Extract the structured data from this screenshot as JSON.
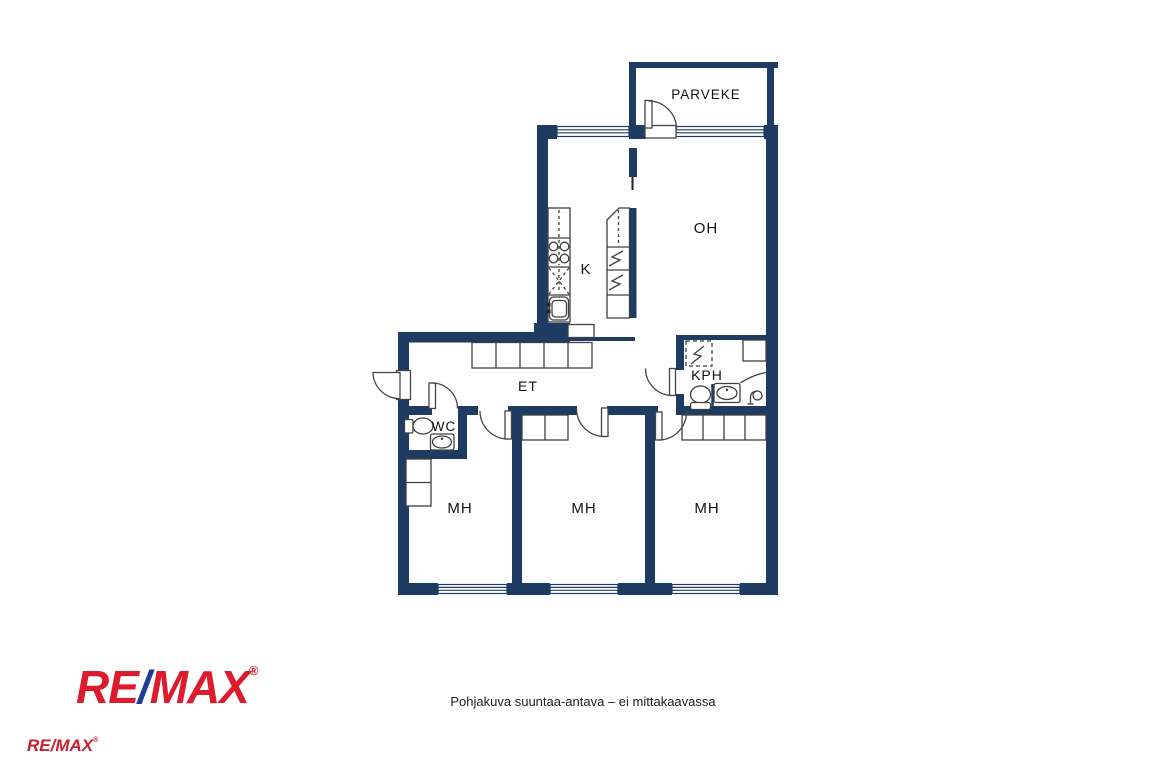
{
  "rooms": {
    "balcony": "PARVEKE",
    "living": "OH",
    "kitchen": "K",
    "hall": "ET",
    "bathroom": "KPH",
    "wc": "WC",
    "bedroom1": "MH",
    "bedroom2": "MH",
    "bedroom3": "MH"
  },
  "footer": {
    "disclaimer": "Pohjakuva suuntaa-antava – ei mittakaavassa"
  },
  "branding": {
    "logo": {
      "re": "RE",
      "slash": "/",
      "max": "MAX",
      "registered": "®"
    },
    "small_logo": {
      "text": "RE/MAX",
      "registered": "®"
    }
  },
  "colors": {
    "wall": "#1E3C62",
    "fixture_line": "#3F3F3F",
    "remax_red": "#DC1C2E",
    "remax_blue": "#1C3E94"
  }
}
